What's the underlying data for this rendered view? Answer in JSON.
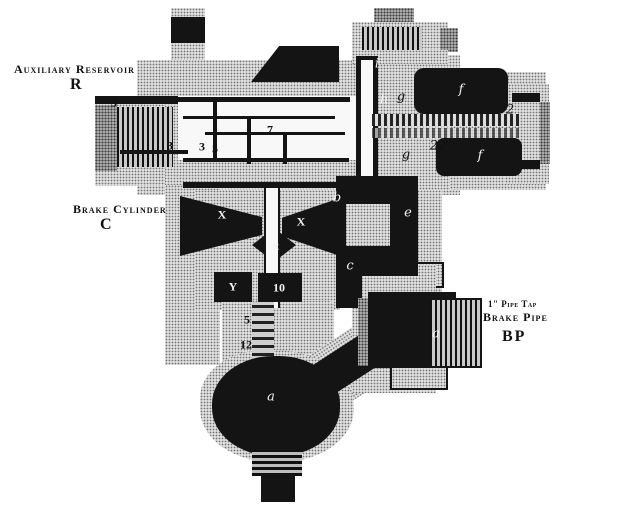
{
  "labels": {
    "aux_reservoir": {
      "line1": "Auxiliary Reservoir",
      "line2": "R"
    },
    "brake_cylinder": {
      "line1": "Brake Cylinder",
      "line2": "C"
    },
    "brake_pipe": {
      "line1": "1\" Pipe Tap",
      "line2": "Brake Pipe",
      "line3": "BP"
    }
  },
  "colors": {
    "ink": "#141414",
    "metal_gray": "#e0e0e0",
    "paper_white": "#ffffff"
  },
  "callouts": [
    {
      "text": "3",
      "x": 114,
      "y": 103,
      "color": "#111111",
      "upright": true
    },
    {
      "text": "3",
      "x": 170,
      "y": 146,
      "color": "#111111",
      "upright": true
    },
    {
      "text": "3",
      "x": 202,
      "y": 147,
      "color": "#111111",
      "upright": true
    },
    {
      "text": "5",
      "x": 215,
      "y": 149,
      "color": "#111111",
      "upright": true
    },
    {
      "text": "7",
      "x": 270,
      "y": 130,
      "color": "#111111",
      "upright": true
    },
    {
      "text": "i",
      "x": 377,
      "y": 64,
      "color": "#f2f2f2",
      "upright": false
    },
    {
      "text": "h",
      "x": 384,
      "y": 100,
      "color": "#f2f2f2",
      "upright": false
    },
    {
      "text": "g",
      "x": 401,
      "y": 97,
      "color": "#111111",
      "upright": false
    },
    {
      "text": "g",
      "x": 406,
      "y": 155,
      "color": "#111111",
      "upright": false
    },
    {
      "text": "f",
      "x": 461,
      "y": 90,
      "color": "#f2f2f2",
      "upright": false
    },
    {
      "text": "f",
      "x": 480,
      "y": 156,
      "color": "#f2f2f2",
      "upright": false
    },
    {
      "text": "2",
      "x": 510,
      "y": 110,
      "color": "#111111",
      "upright": false
    },
    {
      "text": "22",
      "x": 438,
      "y": 146,
      "color": "#111111",
      "upright": false
    },
    {
      "text": "b",
      "x": 337,
      "y": 198,
      "color": "#f2f2f2",
      "upright": false
    },
    {
      "text": "e",
      "x": 408,
      "y": 213,
      "color": "#f2f2f2",
      "upright": false
    },
    {
      "text": "c",
      "x": 350,
      "y": 266,
      "color": "#f2f2f2",
      "upright": false
    },
    {
      "text": "X",
      "x": 222,
      "y": 215,
      "color": "#f2f2f2",
      "upright": true
    },
    {
      "text": "X",
      "x": 301,
      "y": 222,
      "color": "#f2f2f2",
      "upright": true
    },
    {
      "text": "x",
      "x": 276,
      "y": 246,
      "color": "#f2f2f2",
      "upright": true
    },
    {
      "text": "Y",
      "x": 233,
      "y": 287,
      "color": "#f2f2f2",
      "upright": true
    },
    {
      "text": "10",
      "x": 279,
      "y": 288,
      "color": "#f2f2f2",
      "upright": true
    },
    {
      "text": "5",
      "x": 247,
      "y": 320,
      "color": "#111111",
      "upright": true
    },
    {
      "text": "12",
      "x": 246,
      "y": 345,
      "color": "#111111",
      "upright": true
    },
    {
      "text": "a",
      "x": 271,
      "y": 397,
      "color": "#f2f2f2",
      "upright": false
    },
    {
      "text": "a",
      "x": 436,
      "y": 334,
      "color": "#f2f2f2",
      "upright": false
    }
  ]
}
